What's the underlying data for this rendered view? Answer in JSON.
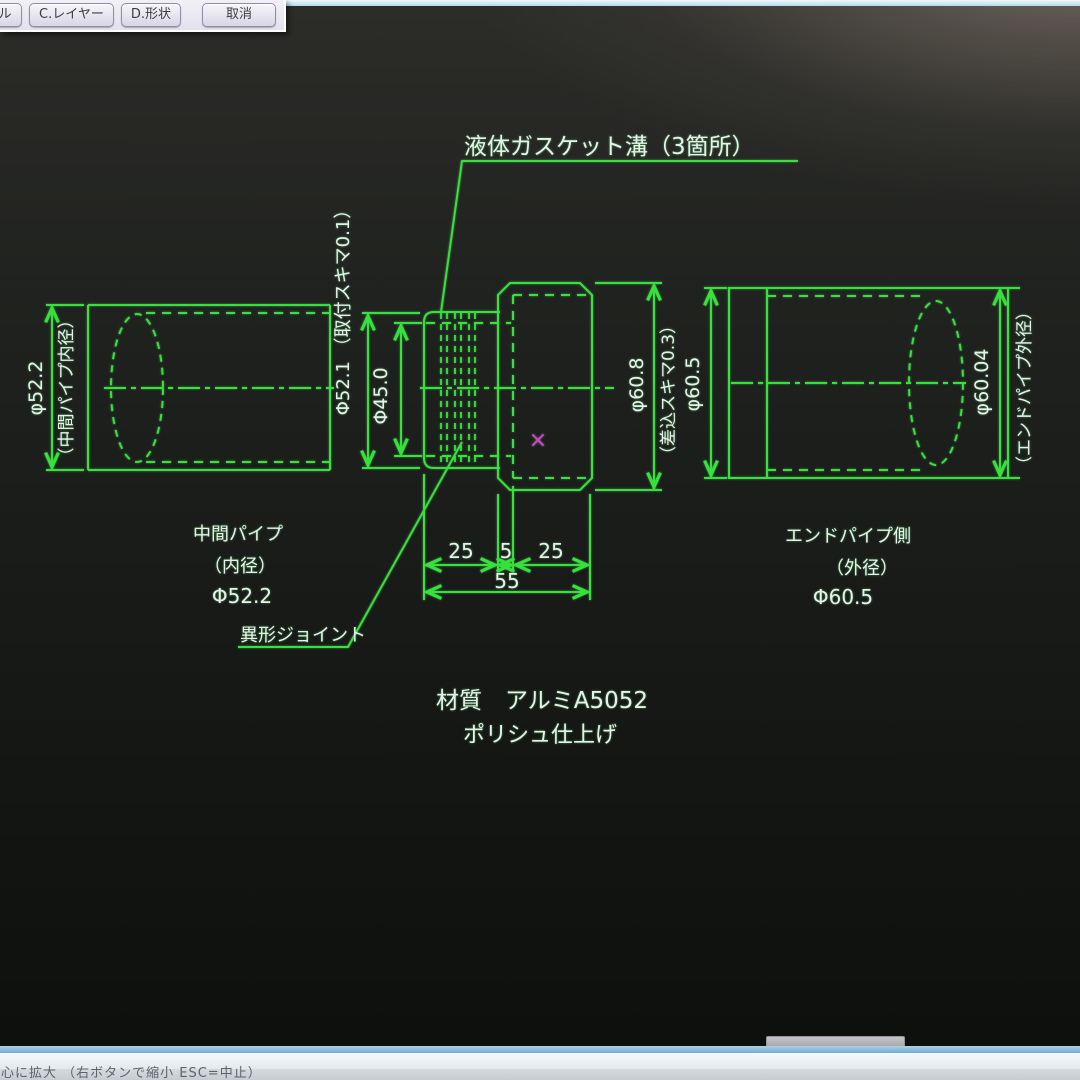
{
  "toolbar": {
    "partial_button_label": "ル",
    "buttons": [
      "C.レイヤー",
      "D.形状",
      "取消"
    ]
  },
  "canvas": {
    "callout_gasket": "液体ガスケット溝（3箇所）",
    "callout_joint": "異形ジョイント",
    "dim_left_pipe_value": "φ52.2",
    "dim_left_pipe_note": "（中間パイプ内径）",
    "dim_spigot": "Φ52.1 （取付スキマ0.1）",
    "dim_bore": "Φ45.0",
    "dim_socket_value": "φ60.8",
    "dim_socket_note": "（差込スキマ0.3）",
    "dim_end_pipe_id": "φ60.5",
    "dim_end_pipe_od_value": "φ60.04",
    "dim_end_pipe_od_note": "（エンドパイプ外径）",
    "dim_len_left": "25",
    "dim_len_mid": "5",
    "dim_len_right": "25",
    "dim_len_total": "55",
    "label_left_pipe": [
      "中間パイプ",
      "（内径）",
      "Φ52.2"
    ],
    "label_right_pipe": [
      "エンドパイプ側",
      "（外径）",
      "Φ60.5"
    ],
    "material": [
      "材質　アルミA5052",
      "ポリシュ仕上げ"
    ],
    "cursor_marker": "×",
    "line_color": "#35e23c",
    "text_color": "#e9efef",
    "cursor_color": "#e538dd"
  },
  "statusbar": {
    "text": "心に拡大 （右ボタンで縮小 ESC=中止）"
  }
}
